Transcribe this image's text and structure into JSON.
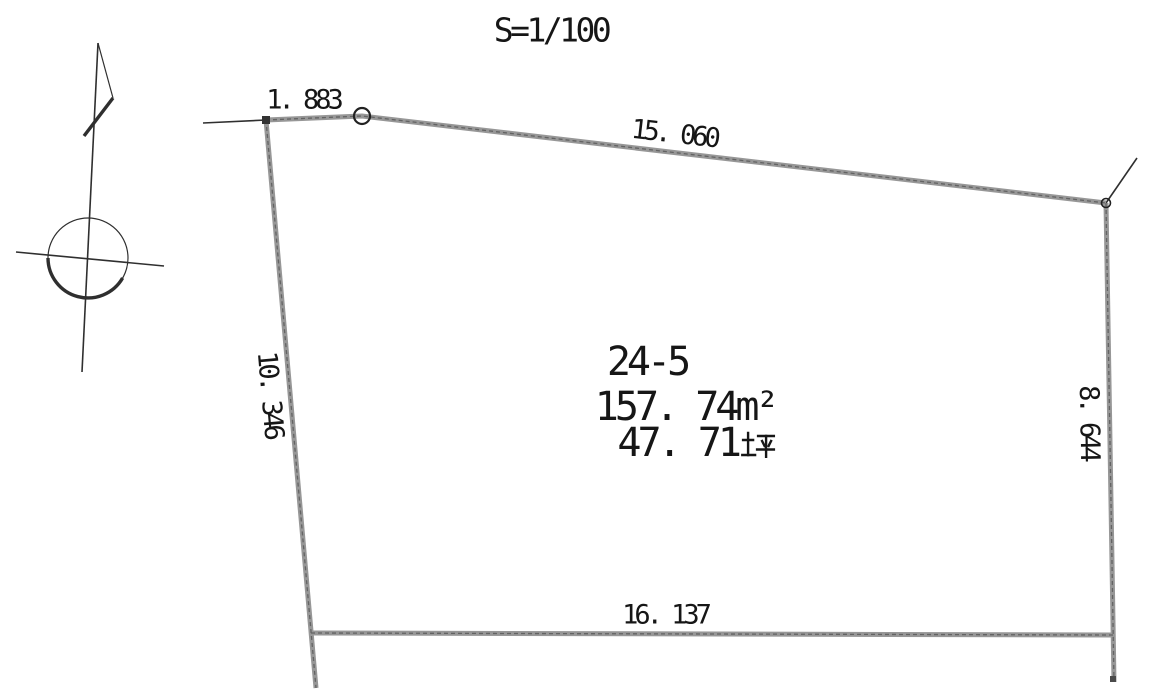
{
  "drawing": {
    "scale_label": "S=1/100",
    "parcel": {
      "lot_number": "24-5",
      "area_sqm_value": "157. 74",
      "area_sqm_unit": "m²",
      "area_tsubo_value": "47. 71",
      "area_tsubo_unit": "坪"
    },
    "dimensions": {
      "top_short": "1. 883",
      "top_long": "15. 060",
      "left": "10. 346",
      "right": "8. 644",
      "bottom": "16. 137"
    },
    "icons": {
      "north_arrow": "north-arrow-icon"
    },
    "colors": {
      "background": "#ffffff",
      "boundary": "#979797",
      "boundary_dark": "#636363",
      "thin_line": "#2f2f2f",
      "text": "#161616"
    }
  }
}
